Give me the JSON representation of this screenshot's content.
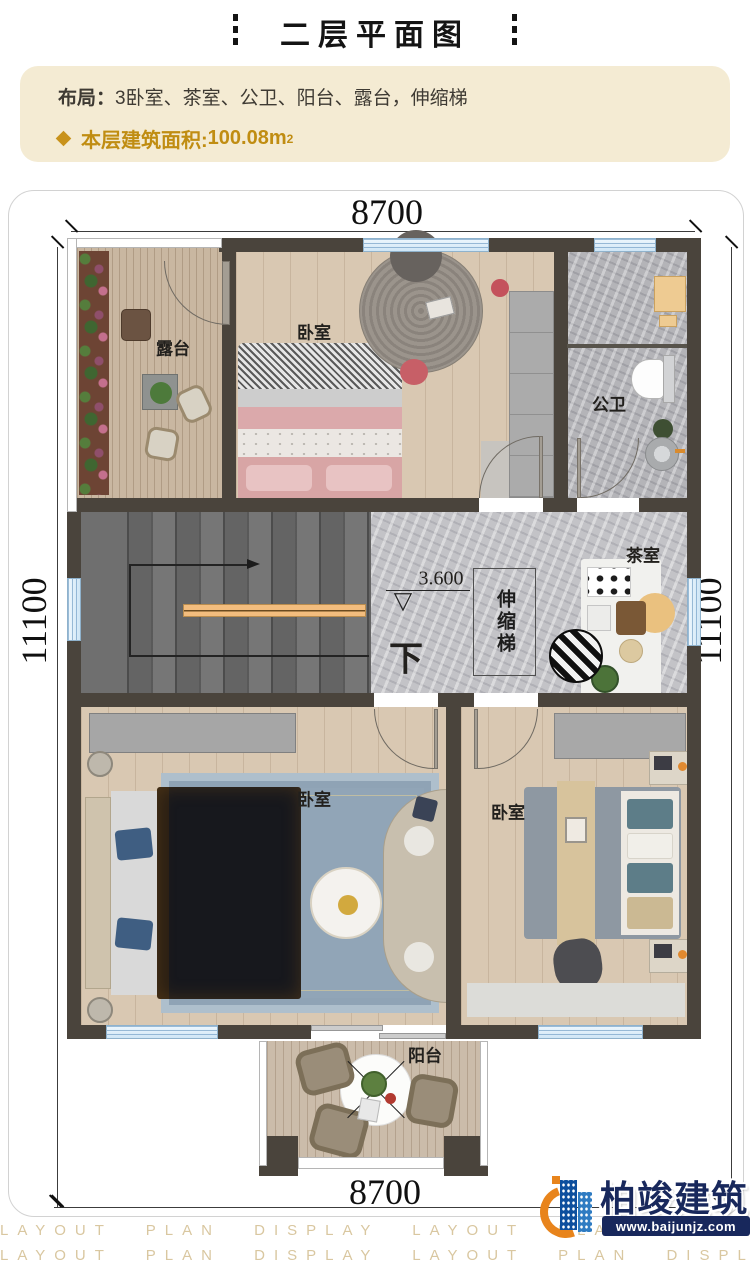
{
  "page": {
    "title": "二层平面图"
  },
  "info": {
    "layout_label": "布局：",
    "layout_value": "3卧室、茶室、公卫、阳台、露台，伸缩梯",
    "area_label": "本层建筑面积:",
    "area_value": "100.08m",
    "area_exponent": "2"
  },
  "dimensions": {
    "width_top": "8700",
    "width_bottom": "8700",
    "height_left": "11100",
    "height_right": "11100"
  },
  "rooms": {
    "terrace": "露台",
    "bedroom_top": "卧室",
    "bathroom": "公卫",
    "tea_room": "茶室",
    "retractable_stair": "伸缩梯",
    "bedroom_left": "卧室",
    "bedroom_right": "卧室",
    "balcony": "阳台"
  },
  "marks": {
    "level": "3.600",
    "down": "下",
    "level_symbol": "▽"
  },
  "footer": {
    "watermark": "LAYOUT PLAN DISPLAY LAYOUT PLAN DISPLAY",
    "brand": "柏竣建筑",
    "website": "www.baijunjz.com"
  },
  "colors": {
    "accent_gold": "#c3911c",
    "info_bg": "#f4ebd3",
    "wall": "#4a443c",
    "window_blue": "#d8eaf8",
    "carpet_blue": "#97aaba",
    "handrail_orange": "#f2bc80",
    "logo_navy": "#18285c",
    "logo_orange": "#e8841c"
  }
}
